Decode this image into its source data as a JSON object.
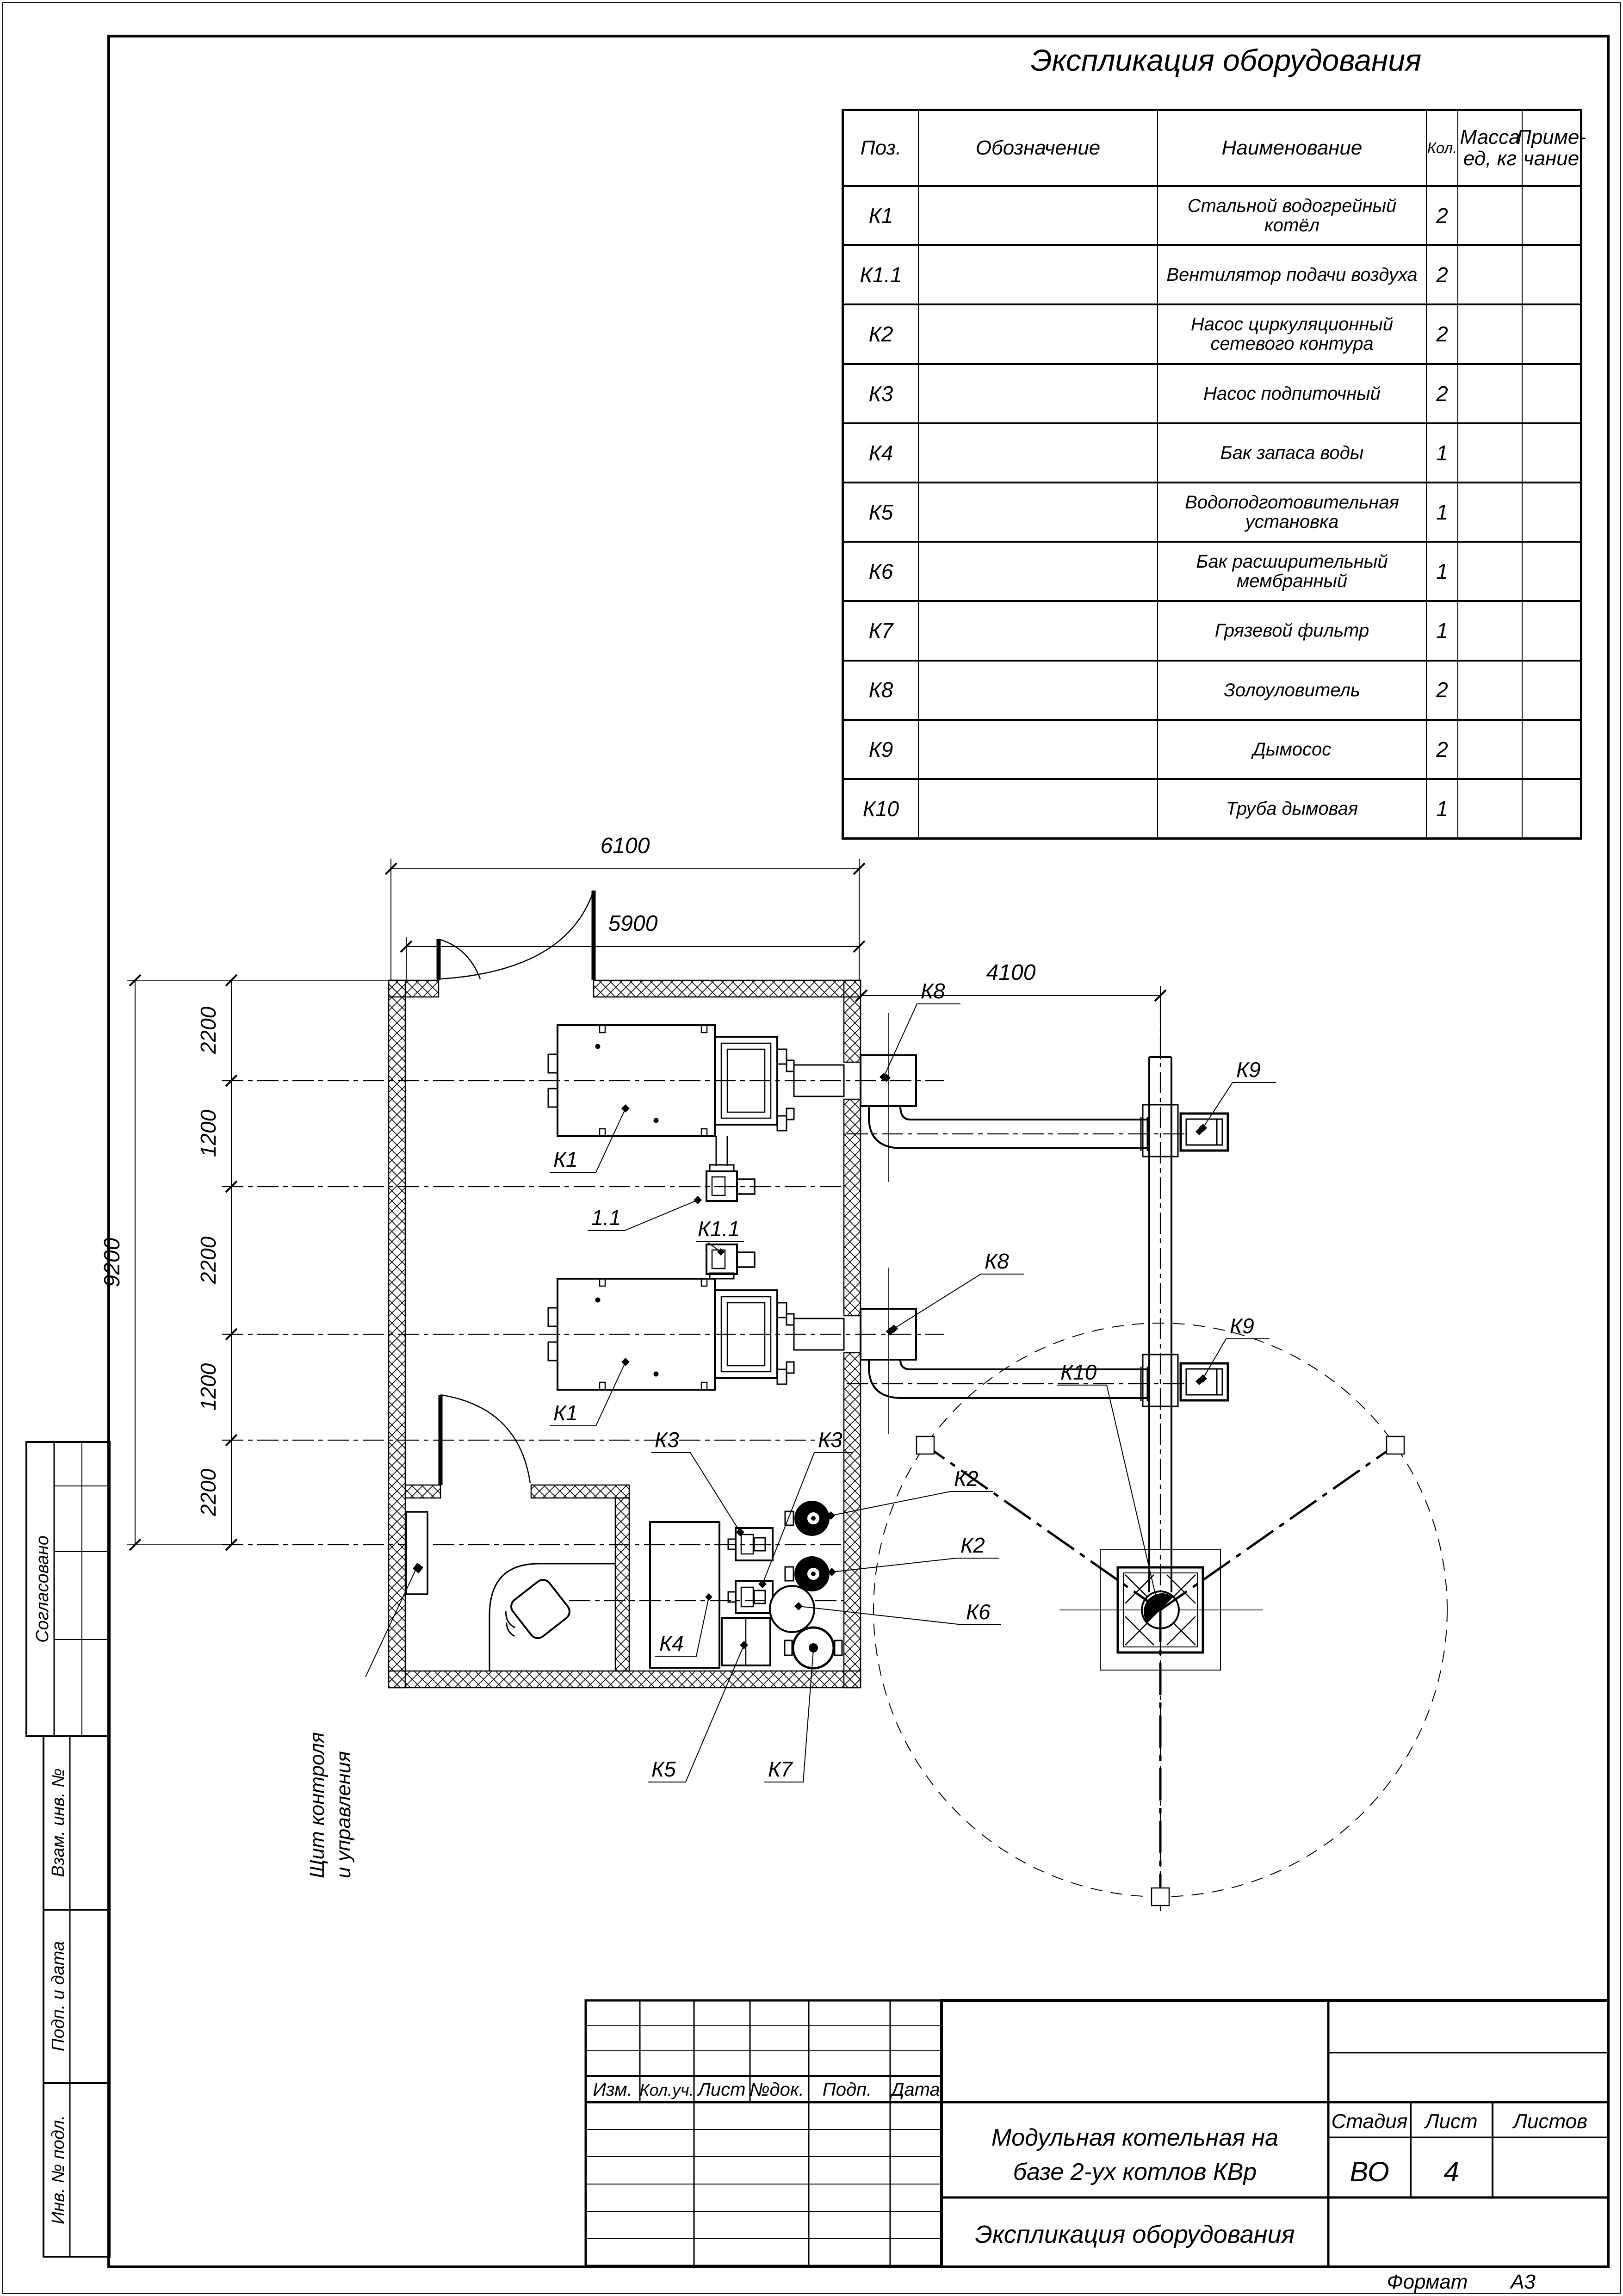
{
  "page_title": "Экспликация оборудования",
  "equipment_table": {
    "headers": {
      "pos": "Поз.",
      "designation": "Обозначение",
      "name": "Наименование",
      "qty": "Кол.",
      "mass1": "Масса",
      "mass2": "ед, кг",
      "note1": "Приме-",
      "note2": "чание"
    },
    "rows": [
      {
        "pos": "К1",
        "designation": "",
        "name": "Стальной водогрейный котёл",
        "qty": "2",
        "mass": "",
        "note": ""
      },
      {
        "pos": "К1.1",
        "designation": "",
        "name": "Вентилятор подачи воздуха",
        "qty": "2",
        "mass": "",
        "note": ""
      },
      {
        "pos": "К2",
        "designation": "",
        "name": "Насос циркуляционный сетевого контура",
        "qty": "2",
        "mass": "",
        "note": ""
      },
      {
        "pos": "К3",
        "designation": "",
        "name": "Насос подпиточный",
        "qty": "2",
        "mass": "",
        "note": ""
      },
      {
        "pos": "К4",
        "designation": "",
        "name": "Бак запаса воды",
        "qty": "1",
        "mass": "",
        "note": ""
      },
      {
        "pos": "К5",
        "designation": "",
        "name": "Водоподготовительная установка",
        "qty": "1",
        "mass": "",
        "note": ""
      },
      {
        "pos": "К6",
        "designation": "",
        "name": "Бак расширительный мембранный",
        "qty": "1",
        "mass": "",
        "note": ""
      },
      {
        "pos": "К7",
        "designation": "",
        "name": "Грязевой фильтр",
        "qty": "1",
        "mass": "",
        "note": ""
      },
      {
        "pos": "К8",
        "designation": "",
        "name": "Золоуловитель",
        "qty": "2",
        "mass": "",
        "note": ""
      },
      {
        "pos": "К9",
        "designation": "",
        "name": "Дымосос",
        "qty": "2",
        "mass": "",
        "note": ""
      },
      {
        "pos": "К10",
        "designation": "",
        "name": "Труба дымовая",
        "qty": "1",
        "mass": "",
        "note": ""
      }
    ]
  },
  "plan": {
    "dims": {
      "top_outer": "6100",
      "top_inner": "5900",
      "flue_offset": "4100",
      "left_total": "9200",
      "left_chain": [
        "2200",
        "1200",
        "2200",
        "1200",
        "2200"
      ]
    },
    "labels": {
      "k1": "К1",
      "v11": "1.1",
      "k11": "К1.1",
      "k2": "К2",
      "k3": "К3",
      "k4": "К4",
      "k5": "К5",
      "k6": "К6",
      "k7": "К7",
      "k8": "К8",
      "k9": "К9",
      "k10": "К10"
    },
    "annotation": {
      "line1": "Щит контроля",
      "line2": "и управления"
    }
  },
  "left_stamp": {
    "agreed": "Согласовано",
    "vzam": "Взам. инв. №",
    "podp": "Подп. и дата",
    "inv": "Инв. № подл."
  },
  "revision_table": {
    "headers": [
      "Изм.",
      "Кол.уч.",
      "Лист",
      "№док.",
      "Подп.",
      "Дата"
    ]
  },
  "title_block": {
    "project_line1": "Модульная котельная на",
    "project_line2": "базе 2-ух котлов КВр",
    "stage_label": "Стадия",
    "stage_value": "ВО",
    "sheet_label": "Лист",
    "sheet_value": "4",
    "sheets_label": "Листов",
    "sheets_value": "",
    "doc_title": "Экспликация оборудования",
    "format_label": "Формат",
    "format_value": "А3"
  }
}
